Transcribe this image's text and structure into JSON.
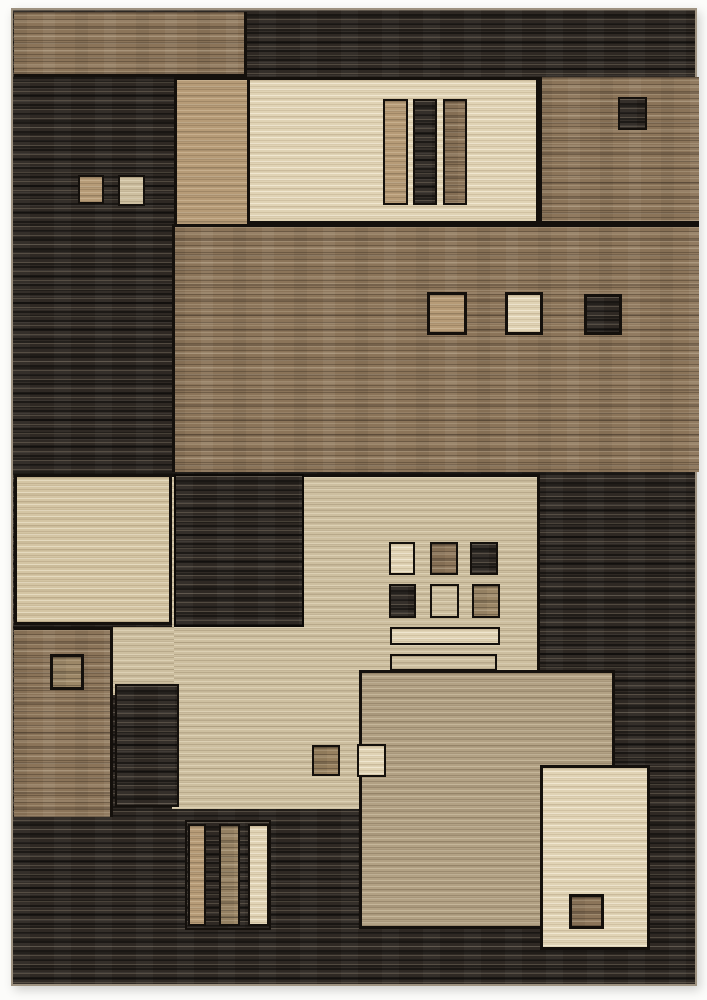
{
  "scene": {
    "type": "product-photo",
    "subject": "Modern geometric patchwork area rug on a white background",
    "pattern": "Overlapping color-block rectangles and small inset squares with fine horizontal striation texture",
    "orientation": "portrait",
    "visible_text": ""
  },
  "palette": {
    "page_bg": "#fcfcfa",
    "rug_dark": "#2e2823",
    "outline": "#14100c",
    "brown": "#8b7459",
    "brown_light": "#9c8767",
    "tan": "#b69b77",
    "cream": "#e0d3b5",
    "cream_dim": "#d4c5a4",
    "beige": "#cdbfa0",
    "taupe": "#b2a184",
    "edge_binding": "#9e9280"
  },
  "motifs": {
    "top": "brown band left, charcoal band right; cream panel with three vertical bars (tan, charcoal, brown); brown block with small charcoal square; two small squares on left charcoal field",
    "middle": "wide brown striated band with three small squares (tan, cream, charcoal)",
    "lower_middle": "cream rectangle; charcoal block; beige field with 3x2 grid of small squares and three stacked horizontal bars (cream, beige, charcoal); taupe block; small brown and cream squares",
    "bottom": "charcoal field with trio of vertical bars (tan, brown, cream); cream rectangle with brown square at lower right"
  }
}
